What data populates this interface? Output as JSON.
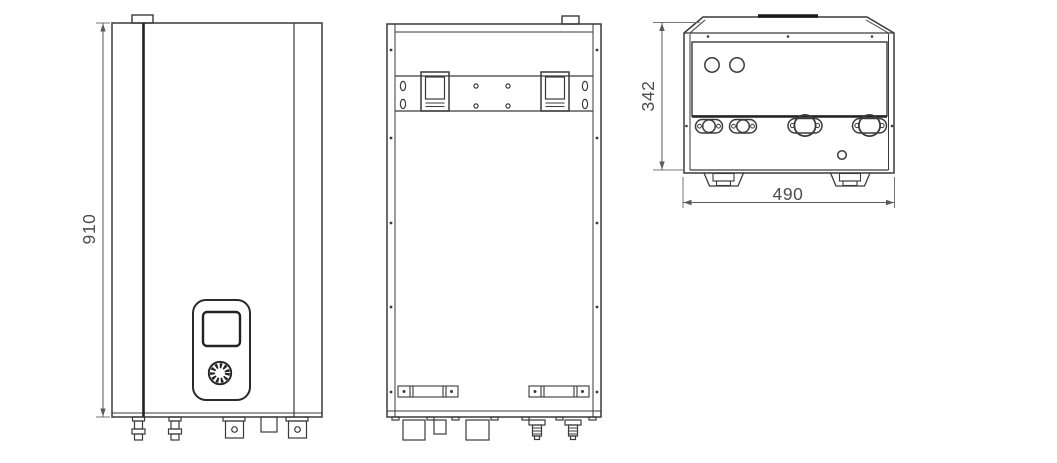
{
  "drawing": {
    "views": {
      "front": {
        "name": "front-view"
      },
      "back": {
        "name": "rear-view-with-mounting-bracket"
      },
      "bottom": {
        "name": "bottom-view-with-pipe-connections"
      }
    },
    "dimensions": {
      "height": {
        "value": "910",
        "orientation": "vertical",
        "view": "front"
      },
      "depth": {
        "value": "342",
        "orientation": "vertical",
        "view": "bottom"
      },
      "width": {
        "value": "490",
        "orientation": "horizontal",
        "view": "bottom"
      }
    },
    "colors": {
      "line": "#3a3a3a",
      "line_bold": "#1f1f1f",
      "dimension_line": "#5a5a5a",
      "dimension_text": "#4d4d4d",
      "background": "#ffffff"
    }
  }
}
